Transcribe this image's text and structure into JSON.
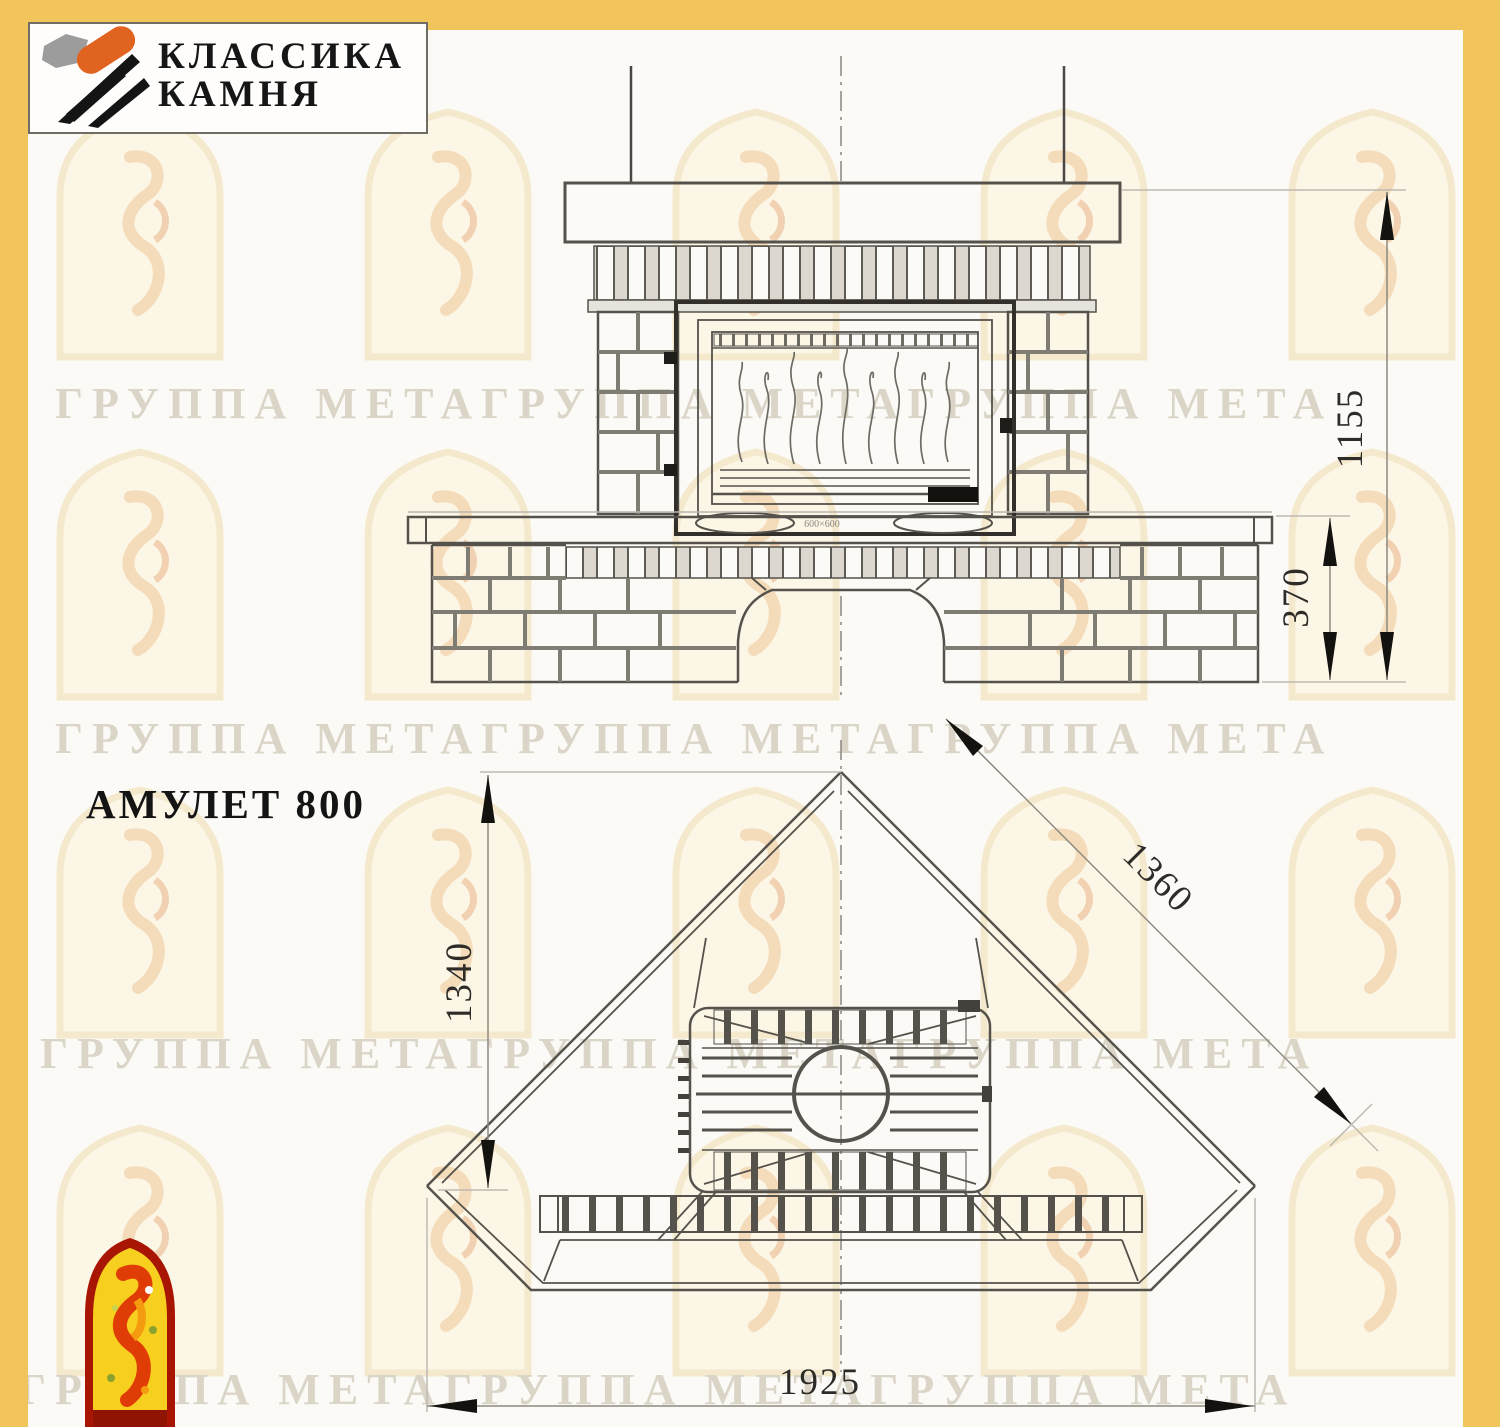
{
  "logo": {
    "line1": "КЛАССИКА",
    "line2": "КАМНЯ",
    "stone_gray": "#9c9c9c",
    "stone_orange": "#e0631f",
    "stroke_black": "#141414"
  },
  "title": "АМУЛЕТ 800",
  "watermark": {
    "text": "ГРУППА МЕТАГРУППА МЕТАГРУППА МЕТА",
    "text_color": "#dbd5c7",
    "arch_fill": "#fcf5e3",
    "arch_outline": "#f4e6c6"
  },
  "page": {
    "background": "#fbfaf7",
    "border_color": "#f2c55c",
    "line_color": "#55524c",
    "arrow_color": "#14120f"
  },
  "drawing": {
    "front_view": {
      "dim_total_height": "1155",
      "dim_base_height": "370",
      "insert_marking": "600×600"
    },
    "plan_view": {
      "dim_depth": "1340",
      "dim_diagonal": "1360",
      "dim_width": "1925"
    }
  }
}
